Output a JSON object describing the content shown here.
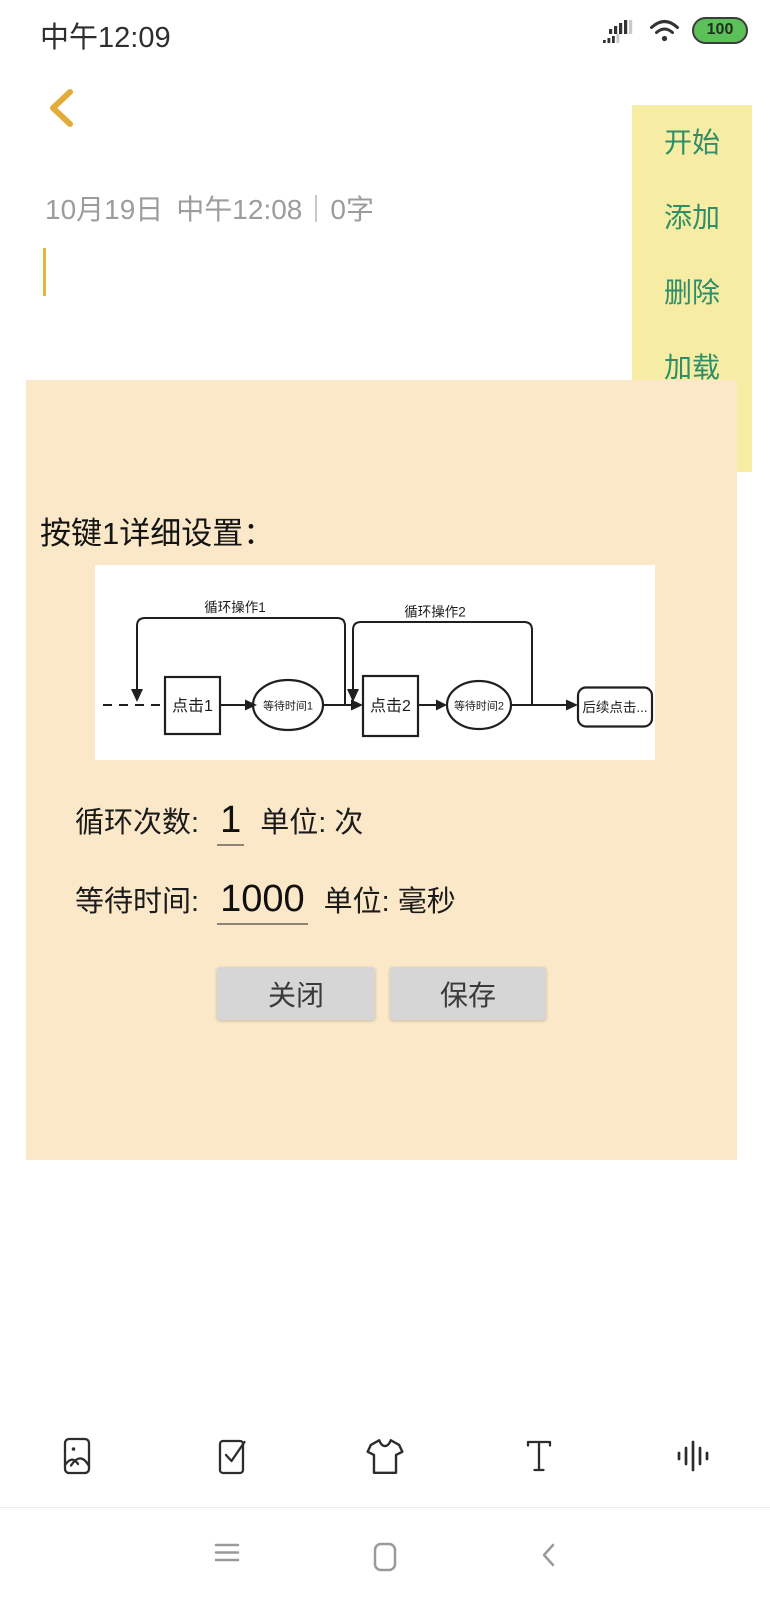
{
  "status_bar": {
    "time": "中午12:09",
    "battery_level": "100"
  },
  "note": {
    "date": "10月19日",
    "time": "中午12:08",
    "char_count": "0字"
  },
  "sidebar": {
    "items": [
      {
        "label": "开始"
      },
      {
        "label": "添加"
      },
      {
        "label": "删除"
      },
      {
        "label": "加载"
      }
    ]
  },
  "dialog": {
    "title": "按键1详细设置：",
    "flowchart": {
      "loop1": "循环操作1",
      "loop2": "循环操作2",
      "click1": "点击1",
      "wait1": "等待时间1",
      "click2": "点击2",
      "wait2": "等待时间2",
      "next": "后续点击..."
    },
    "loop_count": {
      "label": "循环次数:",
      "value": "1",
      "unit": "单位: 次"
    },
    "wait_time": {
      "label": "等待时间:",
      "value": "1000",
      "unit": "单位: 毫秒"
    },
    "close_label": "关闭",
    "save_label": "保存"
  },
  "toolbar": {
    "icons": [
      "image",
      "checklist",
      "tshirt",
      "text-format",
      "audio-waveform"
    ]
  },
  "nav": {
    "icons": [
      "menu",
      "home",
      "back"
    ]
  },
  "colors": {
    "accent_gold": "#E2AC3A",
    "sidebar_bg": "#F6ECA3",
    "sidebar_text_green": "#2F8E68",
    "dialog_bg": "#FBE8C8",
    "battery_green": "#5CC158",
    "button_gray": "#D6D6D6"
  }
}
